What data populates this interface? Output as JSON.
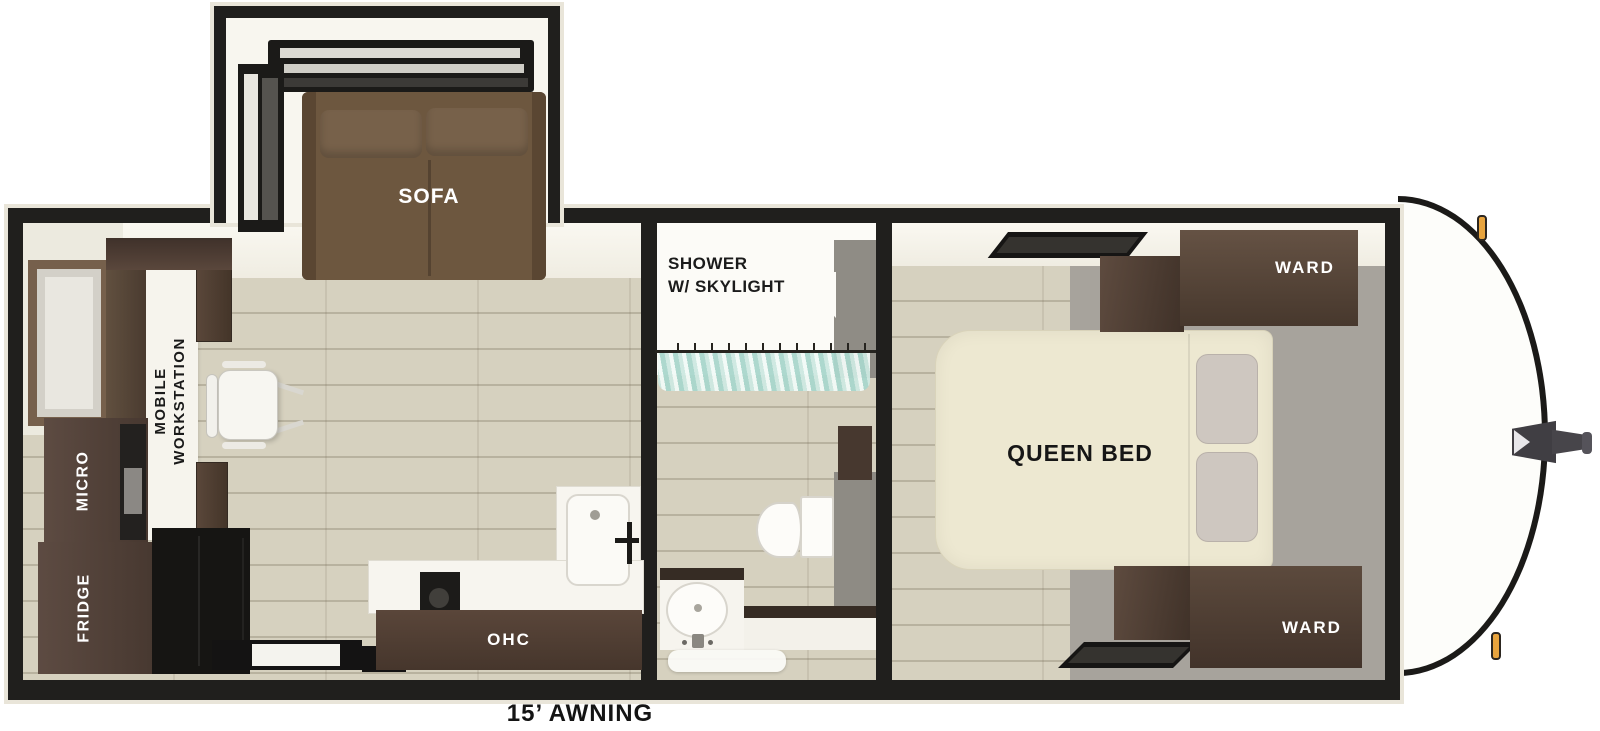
{
  "floorplan": {
    "awning_label": "15’ AWNING",
    "slideout": {
      "sofa_label": "SOFA"
    },
    "living": {
      "workstation_line1": "MOBILE",
      "workstation_line2": "WORKSTATION",
      "micro_label": "MICRO",
      "fridge_label": "FRIDGE",
      "ohc_label": "OHC"
    },
    "bath": {
      "shower_line1": "SHOWER",
      "shower_line2": "W/ SKYLIGHT"
    },
    "bedroom": {
      "bed_label": "QUEEN BED",
      "ward_top_label": "WARD",
      "ward_bottom_label": "WARD"
    },
    "colors": {
      "wall": "#201f1d",
      "trim": "#e9e5d9",
      "wood_floor": "#d6d1bf",
      "carpet": "#a7a39c",
      "sofa_brown": "#6d573f",
      "cabinet_brown": "#54423a",
      "counter_black": "#161513",
      "bed_cream": "#ede8d1",
      "curtain_aqua": "#a9d6cc",
      "marker_amber": "#e8a43e"
    }
  }
}
